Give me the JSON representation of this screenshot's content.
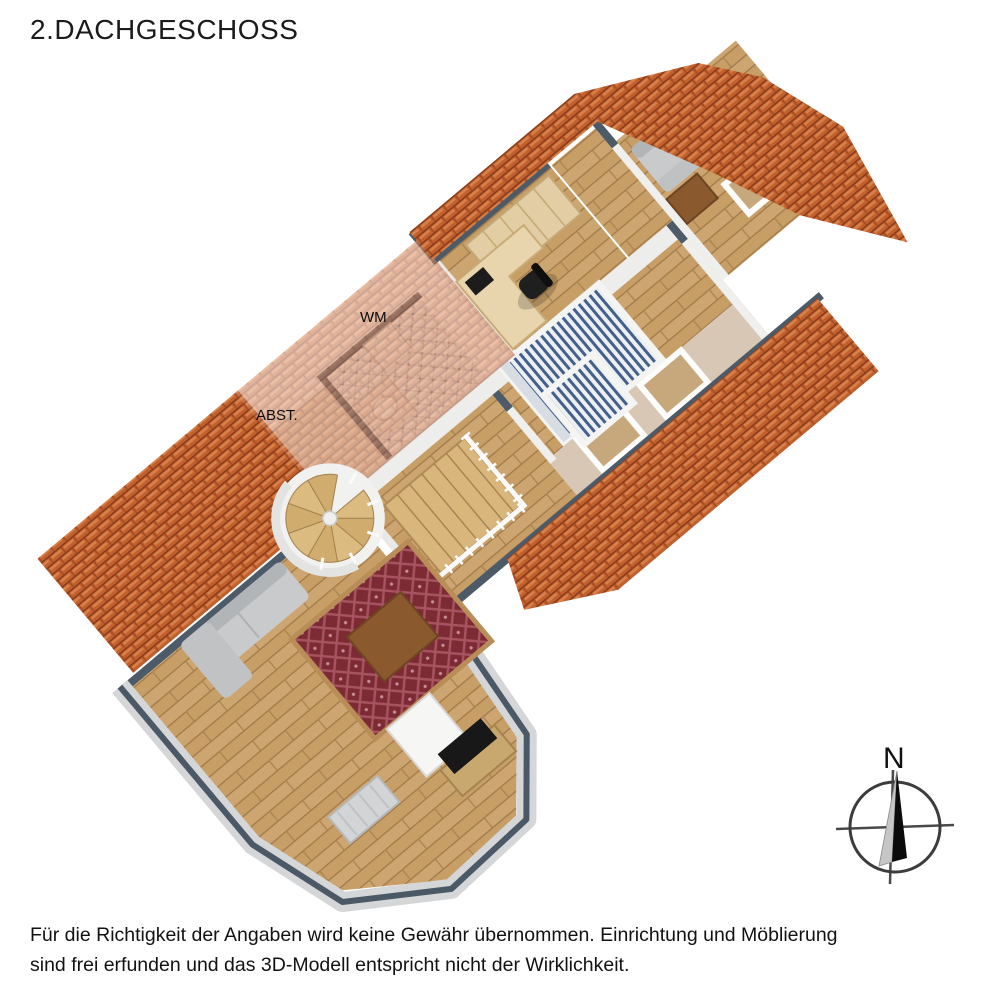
{
  "title": "2.DACHGESCHOSS",
  "plan": {
    "labels": {
      "wm": "WM",
      "abst": "ABST."
    }
  },
  "compass": {
    "north_label": "N"
  },
  "disclaimer": {
    "line1": "Für die Richtigkeit der Angaben wird keine Gewähr übernommen. Einrichtung und Möblierung",
    "line2": "sind frei erfunden und das 3D-Modell entspricht nicht der Wirklichkeit."
  },
  "colors": {
    "roof_tile": "#c2602d",
    "roof_shadow": "#8a3c1b",
    "roof_highlight": "#dd8c55",
    "pink_roof_tint": "#e8c7b6",
    "wall_cap": "#4d5a68",
    "wall_outer": "#d4d6d8",
    "wall_inner": "#efefed",
    "floor_wood": "#c79e66",
    "stair_wood": "#d8b67c",
    "bathroom_tile": "#f3f4f5",
    "sloped_ceiling_tan": "#d9c7b5",
    "bed_stripe_blue": "#44608a",
    "bed_frame": "#f4f4f2",
    "sofa_gray": "#c8cacc",
    "rug_red": "#7c2a34",
    "rug_border": "#b98d57",
    "cabinet_wood": "#e2cda5",
    "furniture_brown": "#8a5a2e",
    "tv_black": "#181818",
    "radiator_gray": "#d2d4d6",
    "chimney_white": "#f6f6f4"
  }
}
